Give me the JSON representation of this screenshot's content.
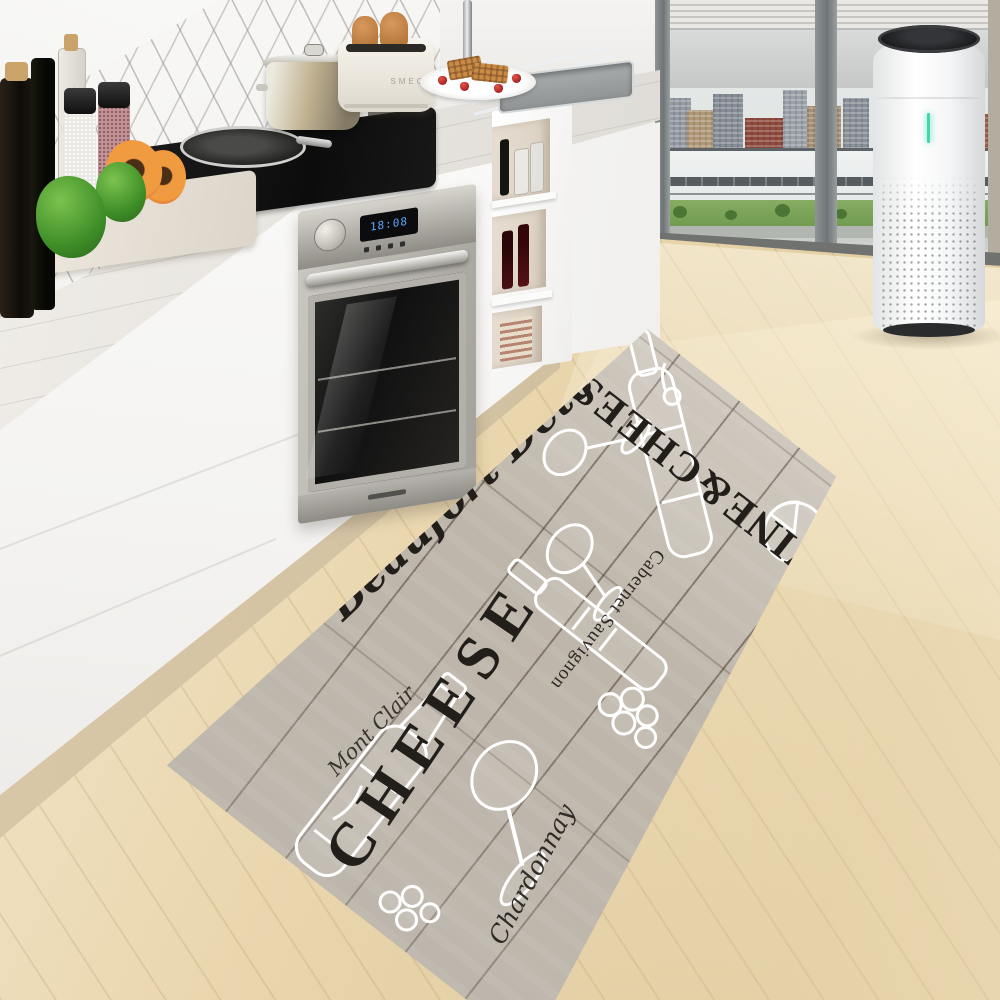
{
  "meta": {
    "type": "product-photo",
    "subject": "Wine and cheese wood-plank print kitchen runner rug in a modern white kitchen"
  },
  "rug": {
    "texts": {
      "headline": "WINE&CHEESE",
      "script_primary": "Beaufort Dete",
      "varietal": "Cabernet Sauvignon",
      "cheese": "CHEESE",
      "script_corner": "Chardonnay",
      "script_accent": "Mont Clair"
    },
    "colors": {
      "base": "#b8afa3",
      "plank_seam": "#564e43",
      "text": "#221f1b",
      "sketch": "#ffffff"
    }
  },
  "appliances": {
    "toaster": {
      "brand": "SMEG",
      "body_color": "#f6f3ec"
    },
    "oven": {
      "display": "18:08",
      "display_color": "#5aa7ff"
    },
    "air_purifier": {
      "led_color": "#3fd6ae",
      "body_color": "#fbfbfc",
      "top_color": "#1a1b1d"
    }
  },
  "room": {
    "palette": {
      "floor_wood": "#e9d6ae",
      "cabinet_white": "#f5f4f2",
      "counter_marble": "#e7e4df",
      "tile_grout": "#c2c0bd",
      "window_mullion": "#7e8385",
      "park_green": "#76a055",
      "landmark_white": "#eef0f0",
      "building_red": "#8e4a3d"
    }
  }
}
